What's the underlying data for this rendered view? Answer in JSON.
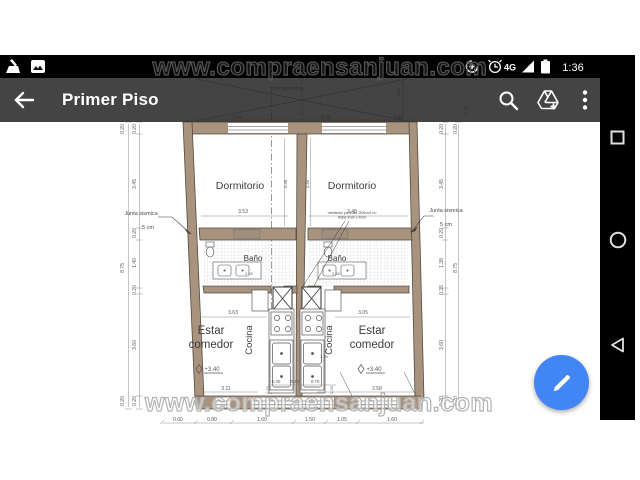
{
  "status_bar": {
    "time": "1:36",
    "network": "4G",
    "icons": [
      "broom-icon",
      "photo-icon",
      "data-saver-icon",
      "alarm-icon",
      "signal-icon",
      "battery-icon"
    ]
  },
  "toolbar": {
    "title": "Primer Piso",
    "icons": [
      "back-arrow-icon",
      "search-icon",
      "drive-add-icon",
      "overflow-menu-icon"
    ]
  },
  "nav_bar": {
    "buttons": [
      "recents",
      "home",
      "back"
    ]
  },
  "fab": {
    "icon": "pencil-icon"
  },
  "watermark": {
    "text": "www.compraensanjuan.com"
  },
  "colors": {
    "wall": "#a8937f",
    "fab": "#4285f4",
    "plan_line": "#4d4d4d",
    "dim_line": "#8a8a8a"
  },
  "floor_plan": {
    "labels": [
      {
        "t": "Dormitorio",
        "x": 240,
        "y": 189,
        "s": 10.5,
        "c": "room"
      },
      {
        "t": "Dormitorio",
        "x": 352,
        "y": 189,
        "s": 10.5,
        "c": "room"
      },
      {
        "t": "Baño",
        "x": 253,
        "y": 261,
        "s": 8,
        "c": "room"
      },
      {
        "t": "Baño",
        "x": 337,
        "y": 261,
        "s": 8,
        "c": "room"
      },
      {
        "t": "Cocina",
        "x": 252,
        "y": 340,
        "s": 9.5,
        "r": -90,
        "c": "room"
      },
      {
        "t": "Cocina",
        "x": 332,
        "y": 340,
        "s": 9.5,
        "r": -90,
        "c": "room"
      },
      {
        "t": "Estar",
        "x": 211,
        "y": 334,
        "s": 11.5,
        "c": "room"
      },
      {
        "t": "comedor",
        "x": 211,
        "y": 348,
        "s": 11.5,
        "c": "room"
      },
      {
        "t": "Estar",
        "x": 372,
        "y": 334,
        "s": 11.5,
        "c": "room"
      },
      {
        "t": "comedor",
        "x": 372,
        "y": 348,
        "s": 11.5,
        "c": "room"
      },
      {
        "t": "+3.40",
        "x": 212,
        "y": 371,
        "s": 6,
        "c": "dim"
      },
      {
        "t": "+3.40",
        "x": 374,
        "y": 371,
        "s": 6,
        "c": "dim"
      },
      {
        "t": "Junta sismica",
        "x": 141,
        "y": 215,
        "s": 5.5,
        "c": "note"
      },
      {
        "t": "5 cm",
        "x": 148,
        "y": 229,
        "s": 5.5,
        "c": "note"
      },
      {
        "t": "Junta sismica",
        "x": 446,
        "y": 212,
        "s": 5.5,
        "c": "note"
      },
      {
        "t": "5 cm",
        "x": 446,
        "y": 226,
        "s": 5.5,
        "c": "note"
      },
      {
        "t": "transparente",
        "x": 288,
        "y": 90,
        "s": 5.5,
        "c": "note"
      },
      {
        "t": "Ventilacion por ducto 2000cm2 c/u",
        "x": 352,
        "y": 214,
        "s": 3.2,
        "c": "note"
      },
      {
        "t": "Rejilla 40cm x 40cm",
        "x": 352,
        "y": 218.5,
        "s": 3.2,
        "c": "note"
      },
      {
        "t": "3.44",
        "x": 237,
        "y": 119,
        "s": 5,
        "c": "dim"
      },
      {
        "t": "0.20",
        "x": 326,
        "y": 119,
        "s": 5,
        "c": "dim"
      },
      {
        "t": "3.93",
        "x": 398,
        "y": 119,
        "s": 5,
        "c": "dim"
      },
      {
        "t": "0.05",
        "x": 467,
        "y": 110,
        "s": 4,
        "r": -90,
        "c": "dim"
      },
      {
        "t": "2.03",
        "x": 400,
        "y": 92,
        "s": 4.5,
        "r": -90,
        "c": "dim"
      },
      {
        "t": "0.20",
        "x": 124,
        "y": 129,
        "s": 5,
        "r": -90,
        "c": "dim"
      },
      {
        "t": "8.75",
        "x": 124,
        "y": 268,
        "s": 5,
        "r": -90,
        "c": "dim"
      },
      {
        "t": "0.20",
        "x": 124,
        "y": 401,
        "s": 5,
        "r": -90,
        "c": "dim"
      },
      {
        "t": "0.20",
        "x": 136,
        "y": 129,
        "s": 5,
        "r": -90,
        "c": "dim"
      },
      {
        "t": "3.45",
        "x": 136,
        "y": 184,
        "s": 5,
        "r": -90,
        "c": "dim"
      },
      {
        "t": "0.20",
        "x": 136,
        "y": 233,
        "s": 5,
        "r": -90,
        "c": "dim"
      },
      {
        "t": "1.40",
        "x": 136,
        "y": 263,
        "s": 5,
        "r": -90,
        "c": "dim"
      },
      {
        "t": "0.20",
        "x": 136,
        "y": 290,
        "s": 5,
        "r": -90,
        "c": "dim"
      },
      {
        "t": "3.60",
        "x": 136,
        "y": 345,
        "s": 5,
        "r": -90,
        "c": "dim"
      },
      {
        "t": "0.20",
        "x": 136,
        "y": 401,
        "s": 5,
        "r": -90,
        "c": "dim"
      },
      {
        "t": "0.20",
        "x": 443,
        "y": 129,
        "s": 5,
        "r": -90,
        "c": "dim"
      },
      {
        "t": "3.45",
        "x": 443,
        "y": 184,
        "s": 5,
        "r": -90,
        "c": "dim"
      },
      {
        "t": "0.20",
        "x": 443,
        "y": 233,
        "s": 5,
        "r": -90,
        "c": "dim"
      },
      {
        "t": "1.38",
        "x": 443,
        "y": 263,
        "s": 5,
        "r": -90,
        "c": "dim"
      },
      {
        "t": "0.35",
        "x": 443,
        "y": 290,
        "s": 5,
        "r": -90,
        "c": "dim"
      },
      {
        "t": "3.60",
        "x": 443,
        "y": 345,
        "s": 5,
        "r": -90,
        "c": "dim"
      },
      {
        "t": "0.20",
        "x": 443,
        "y": 401,
        "s": 5,
        "r": -90,
        "c": "dim"
      },
      {
        "t": "0.20",
        "x": 457,
        "y": 129,
        "s": 5,
        "r": -90,
        "c": "dim"
      },
      {
        "t": "8.75",
        "x": 457,
        "y": 268,
        "s": 5,
        "r": -90,
        "c": "dim"
      },
      {
        "t": "0.20",
        "x": 457,
        "y": 401,
        "s": 5,
        "r": -90,
        "c": "dim"
      },
      {
        "t": "3.45",
        "x": 287,
        "y": 184,
        "s": 4.5,
        "r": -90,
        "c": "dim"
      },
      {
        "t": "3.45",
        "x": 309,
        "y": 184,
        "s": 4.5,
        "r": -90,
        "c": "dim"
      },
      {
        "t": "3.53",
        "x": 243,
        "y": 213,
        "s": 5,
        "c": "dim"
      },
      {
        "t": "3.48",
        "x": 352,
        "y": 213,
        "s": 5,
        "c": "dim"
      },
      {
        "t": "2.50",
        "x": 249,
        "y": 275,
        "s": 4,
        "c": "dim"
      },
      {
        "t": "2.50",
        "x": 336,
        "y": 275,
        "s": 4,
        "c": "dim"
      },
      {
        "t": "3.63",
        "x": 233,
        "y": 314,
        "s": 5,
        "c": "dim"
      },
      {
        "t": "3.05",
        "x": 363,
        "y": 314,
        "s": 5,
        "c": "dim"
      },
      {
        "t": "1.30",
        "x": 324,
        "y": 358,
        "s": 4,
        "c": "dim"
      },
      {
        "t": "3.11",
        "x": 226,
        "y": 390,
        "s": 5,
        "c": "dim"
      },
      {
        "t": "2.58",
        "x": 377,
        "y": 390,
        "s": 5,
        "c": "dim"
      },
      {
        "t": "0.40",
        "x": 276,
        "y": 383,
        "s": 4.5,
        "c": "dim"
      },
      {
        "t": "0.60",
        "x": 295,
        "y": 383,
        "s": 4.5,
        "c": "dim"
      },
      {
        "t": "0.70",
        "x": 315,
        "y": 383,
        "s": 4.5,
        "c": "dim"
      },
      {
        "t": "0.20",
        "x": 269,
        "y": 390,
        "s": 4,
        "r": -90,
        "c": "dim"
      },
      {
        "t": "0.20",
        "x": 333,
        "y": 390,
        "s": 4,
        "r": -90,
        "c": "dim"
      },
      {
        "t": "0.60",
        "x": 178,
        "y": 421,
        "s": 5,
        "c": "dim"
      },
      {
        "t": "0.80",
        "x": 212,
        "y": 421,
        "s": 5,
        "c": "dim"
      },
      {
        "t": "1.60",
        "x": 262,
        "y": 421,
        "s": 5,
        "c": "dim"
      },
      {
        "t": "1.50",
        "x": 310,
        "y": 421,
        "s": 5,
        "c": "dim"
      },
      {
        "t": "1.05",
        "x": 342,
        "y": 421,
        "s": 5,
        "c": "dim"
      },
      {
        "t": "1.60",
        "x": 392,
        "y": 421,
        "s": 5,
        "c": "dim"
      }
    ]
  }
}
